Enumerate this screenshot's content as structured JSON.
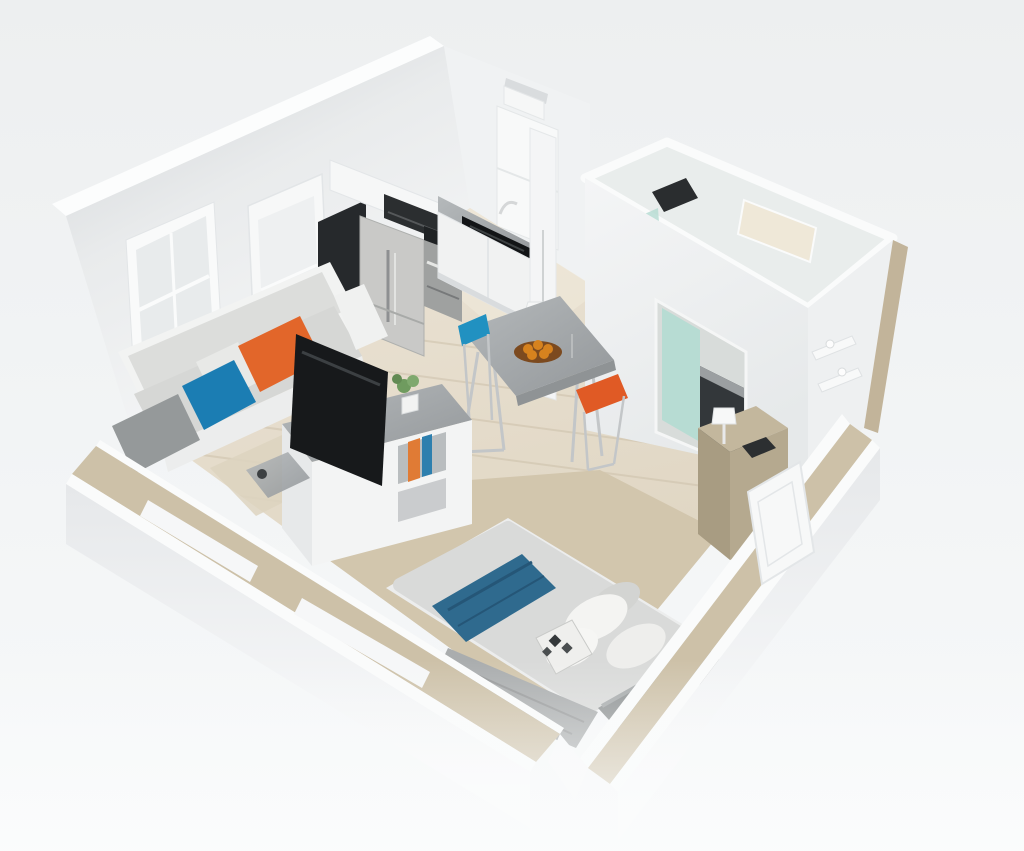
{
  "meta": {
    "description": "3D isometric cutaway (dollhouse) render of a square studio apartment floor plan",
    "style": "photorealistic 3D render, elevated isometric view",
    "visible_text": "none"
  },
  "colors": {
    "background_top": "#edeff0",
    "background_bottom": "#f7f9fa",
    "wall_white": "#f4f5f6",
    "wall_cap_white": "#fcfdfd",
    "wall_shaded_gray": "#ced2d5",
    "tan_wall_cut": "#cdc1a8",
    "tan_wall_face": "#c2b49a",
    "wood_seam": "#cfc3ad",
    "bedroom_carpet_tan": "#d2c6ad",
    "rug_tan": "#ddd3c0",
    "kitchen_floor_light": "#f0e9db",
    "marble_edge_gray": "#8f9395",
    "dark_cabinet": "#26292c",
    "stainless_steel": "#c9c9c7",
    "stainless_dark": "#9fa1a0",
    "black_countertop": "#121416",
    "cooktop_black": "#1f2224",
    "microwave_black": "#2b2e30",
    "white_cabinet": "#f1f2f2",
    "sofa_cushion_gray": "#d6d7d5",
    "sofa_back_gray": "#dcdddb",
    "sofa_frame_white": "#f2f3f2",
    "pillow_gray": "#95999a",
    "pillow_blue": "#1b7db3",
    "pillow_orange": "#e2662a",
    "pillow_white": "#e8e9e7",
    "stool_blue": "#2191c1",
    "stool_orange": "#e05a25",
    "fruit_bowl_brown": "#7c4a1f",
    "fruit_orange": "#d6821e",
    "tv_black": "#17191b",
    "book_orange": "#e07b35",
    "book_blue": "#2d7fae",
    "plant_green": "#6f9b5f",
    "bed_duvet_gray": "#d9dad9",
    "bed_frame_white": "#eceded",
    "bed_runner_blue": "#2f6a8e",
    "bed_knit_gray": "#aaadae",
    "headboard_gray": "#8f9394",
    "pattern_pillow_light": "#efefed",
    "pattern_pillow_dark": "#34383a",
    "shower_glass_teal": "#b7dcd3",
    "bathroom_panel_ivory": "#efe8d8",
    "bathroom_interior": "#e9edec",
    "fixture_dark": "#2a2d2f",
    "vanity_dark": "#33373a",
    "dresser_tan": "#b5a98f",
    "dresser_tan_light": "#c3b79d",
    "dresser_tan_dark": "#a89c82",
    "chrome_metal": "#c3c6c8",
    "window_pane": "#e8ebec",
    "door_white": "#f7f8f8"
  },
  "scene": {
    "view": "isometric cutaway of a square studio apartment, front walls cut low with tan edges",
    "rooms": [
      {
        "name": "kitchen",
        "position": "top-left",
        "items": [
          "white upper cabinets",
          "black microwave",
          "stainless refrigerator",
          "stainless oven with black cooktop",
          "gray stone countertop",
          "black sink with chrome faucet",
          "tall dark pantry cabinet",
          "white corner cabinet",
          "wall vent"
        ]
      },
      {
        "name": "bathroom",
        "position": "top-right",
        "items": [
          "enclosed white room",
          "dark shower fixture",
          "teal glass shower door",
          "ivory mirror panel",
          "dark vanity counter",
          "doorway"
        ]
      },
      {
        "name": "living-area",
        "position": "left",
        "items": [
          "gray sofa with white frame",
          "gray pillow",
          "blue pillow",
          "orange pillow",
          "white pillow",
          "tv console with marble top",
          "black flat-screen tv",
          "potted plant",
          "side shelves with orange and blue books",
          "tan rug",
          "small marble return with lamp"
        ]
      },
      {
        "name": "dining-nook",
        "position": "center",
        "items": [
          "marble bar table with metal legs",
          "bowl of oranges",
          "candlestick",
          "blue folding stool",
          "orange folding stool",
          "white column",
          "white cone pendant lamp"
        ]
      },
      {
        "name": "sleeping-area",
        "position": "bottom-right",
        "items": [
          "bed with light gray duvet",
          "dark blue throw runner",
          "white pillows",
          "black-and-white patterned accent pillow",
          "gray knit foot throw",
          "gray upholstered headboard",
          "tan dresser with black radio and white lamp",
          "white floating wall shelves",
          "tan carpet area",
          "white entry door in low wall"
        ]
      }
    ],
    "architecture": [
      "white interior walls",
      "window and glazed door on the left wall",
      "cut-away low front walls with tan cut surfaces and white caps",
      "light wood plank flooring",
      "white top caps on all walls"
    ]
  }
}
